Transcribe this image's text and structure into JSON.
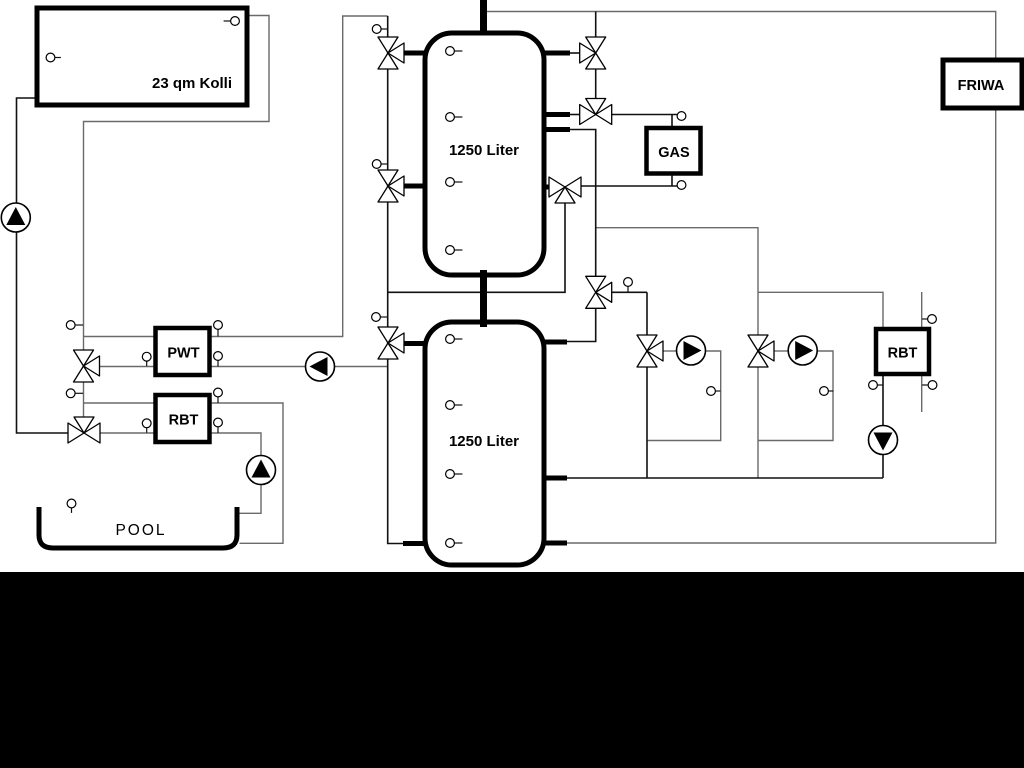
{
  "diagram": {
    "components": {
      "collector": {
        "label": "23 qm Kolli"
      },
      "buffer_tank_top": {
        "label": "1250 Liter"
      },
      "buffer_tank_bottom": {
        "label": "1250 Liter"
      },
      "gas_boiler": {
        "label": "GAS"
      },
      "friwa_station": {
        "label": "FRIWA"
      },
      "pool_heat_exchanger": {
        "label": "PWT"
      },
      "pool_return_unit": {
        "label": "RBT"
      },
      "heating_return_unit": {
        "label": "RBT"
      }
    },
    "pool": {
      "label": "POOL"
    },
    "colors": {
      "background": "#ffffff",
      "pipe_dark": "#111111",
      "pipe_gray": "#6a6a6a",
      "component": "#000000",
      "bottom_bar": "#000000"
    }
  }
}
